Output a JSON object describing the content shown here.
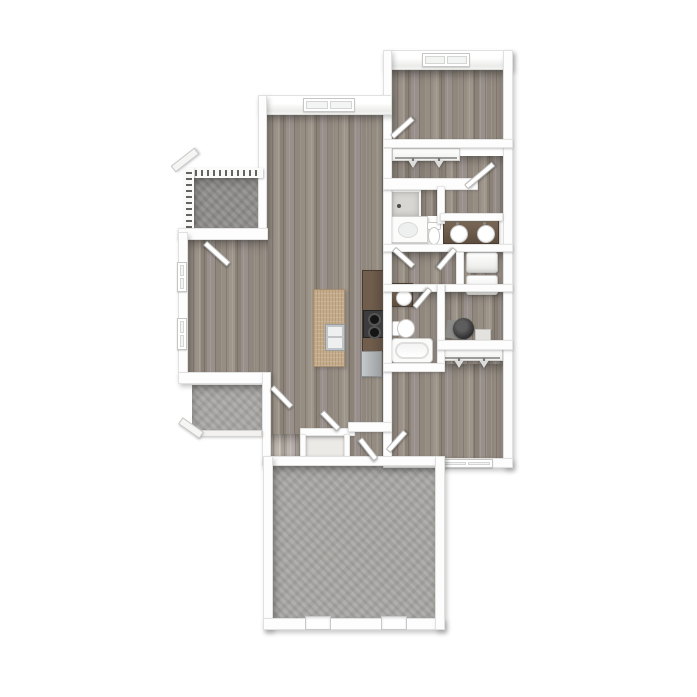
{
  "meta": {
    "description": "3D top-down floor plan rendering of a two-bedroom, two-bath apartment with balcony, entry porch, kitchen island and large patio",
    "visible_text": "none"
  },
  "palette": {
    "background": "#ffffff",
    "wall": "#fdfdfd",
    "wall_edge": "#cfcfcd",
    "wood_floor": "#978e84",
    "concrete_light": "#a9a8a5",
    "concrete_dark": "#8f8e8c",
    "counter_dark": "#5e4d40",
    "island_granite": "#c4ab8b",
    "appliance_steel": "#b7babc",
    "fixture_white": "#fcfcfb",
    "water_heater": "#2d2d2d"
  },
  "elements": [
    {
      "kind": "floor-concrete",
      "variant": "dark",
      "name": "balcony-floor",
      "x": 194,
      "y": 178,
      "w": 69,
      "h": 50
    },
    {
      "kind": "floor-wood",
      "name": "living-dining-floor",
      "x": 267,
      "y": 113,
      "w": 116,
      "h": 345
    },
    {
      "kind": "floor-wood",
      "name": "dining-left-wing-floor",
      "x": 188,
      "y": 240,
      "w": 80,
      "h": 134
    },
    {
      "kind": "floor-wood",
      "name": "bedroom1-floor",
      "x": 392,
      "y": 70,
      "w": 111,
      "h": 70
    },
    {
      "kind": "floor-wood",
      "variant": "dark",
      "name": "master-closet-floor",
      "x": 392,
      "y": 156,
      "w": 68,
      "h": 24
    },
    {
      "kind": "floor-wood",
      "name": "master-bath-right-floor",
      "x": 440,
      "y": 156,
      "w": 63,
      "h": 60
    },
    {
      "kind": "floor-wood",
      "name": "master-bath-left-floor",
      "x": 420,
      "y": 186,
      "w": 18,
      "h": 30
    },
    {
      "kind": "floor-wood",
      "name": "hallway-floor",
      "x": 392,
      "y": 252,
      "w": 66,
      "h": 32
    },
    {
      "kind": "floor-wood",
      "name": "laundry-floor",
      "x": 458,
      "y": 252,
      "w": 45,
      "h": 33
    },
    {
      "kind": "floor-wood",
      "name": "bathroom2-floor",
      "x": 392,
      "y": 292,
      "w": 45,
      "h": 71
    },
    {
      "kind": "floor-wood",
      "name": "utility-floor",
      "x": 445,
      "y": 292,
      "w": 58,
      "h": 50
    },
    {
      "kind": "floor-wood",
      "variant": "dark",
      "name": "bedroom2-closet-floor",
      "x": 440,
      "y": 346,
      "w": 63,
      "h": 20
    },
    {
      "kind": "floor-wood",
      "name": "bedroom2-floor",
      "x": 392,
      "y": 364,
      "w": 111,
      "h": 94
    },
    {
      "kind": "floor-wood",
      "variant": "pale",
      "name": "entry-closet-a-floor",
      "x": 268,
      "y": 434,
      "w": 31,
      "h": 22
    },
    {
      "kind": "floor-tilewhite",
      "name": "entry-closet-b-floor",
      "x": 306,
      "y": 436,
      "w": 40,
      "h": 20
    },
    {
      "kind": "floor-concrete",
      "name": "entry-porch-floor",
      "x": 192,
      "y": 385,
      "w": 70,
      "h": 47
    },
    {
      "kind": "floor-concrete",
      "name": "patio-floor",
      "x": 273,
      "y": 466,
      "w": 162,
      "h": 152
    },
    {
      "kind": "island",
      "name": "kitchen-island",
      "x": 313,
      "y": 289,
      "w": 32,
      "h": 78
    },
    {
      "kind": "counter",
      "name": "kitchen-counter",
      "x": 362,
      "y": 270,
      "w": 25,
      "h": 82
    },
    {
      "kind": "stove",
      "name": "stove-cooktop",
      "x": 363,
      "y": 310,
      "w": 23,
      "h": 28
    },
    {
      "kind": "fridge",
      "name": "refrigerator",
      "x": 361,
      "y": 351,
      "w": 21,
      "h": 26
    },
    {
      "kind": "closetrod",
      "name": "master-closet-rod",
      "x": 392,
      "y": 148,
      "w": 68,
      "h": 13
    },
    {
      "kind": "shower",
      "name": "master-shower",
      "x": 390,
      "y": 190,
      "w": 31,
      "h": 28
    },
    {
      "kind": "vanity-white",
      "name": "master-vanity",
      "x": 391,
      "y": 216,
      "w": 37,
      "h": 27
    },
    {
      "kind": "toilet-down",
      "name": "master-toilet",
      "x": 426,
      "y": 222,
      "w": 14,
      "h": 21
    },
    {
      "kind": "vanity-brown-double",
      "name": "master-double-vanity",
      "x": 443,
      "y": 220,
      "w": 56,
      "h": 24
    },
    {
      "kind": "wd",
      "name": "washer-dryer-stack",
      "x": 466,
      "y": 252,
      "w": 32,
      "h": 43
    },
    {
      "kind": "wh",
      "name": "water-heater",
      "x": 446,
      "y": 316,
      "w": 28,
      "h": 26
    },
    {
      "kind": "shelf",
      "name": "utility-shelf",
      "x": 475,
      "y": 329,
      "w": 16,
      "h": 13
    },
    {
      "kind": "closetrod",
      "name": "bedroom2-closet-rod",
      "x": 440,
      "y": 348,
      "w": 63,
      "h": 13
    },
    {
      "kind": "vanity-brown-single",
      "name": "bathroom2-vanity",
      "x": 391,
      "y": 283,
      "w": 22,
      "h": 24
    },
    {
      "kind": "toilet-right",
      "name": "bathroom2-toilet",
      "x": 392,
      "y": 318,
      "w": 21,
      "h": 19
    },
    {
      "kind": "tub",
      "name": "bathroom2-tub",
      "x": 391,
      "y": 338,
      "w": 42,
      "h": 25
    },
    {
      "kind": "wall",
      "variant": "face outer",
      "name": "bedroom1-top-wall",
      "x": 383,
      "y": 50,
      "w": 130,
      "h": 20
    },
    {
      "kind": "window-h",
      "name": "bedroom1-window",
      "x": 422,
      "y": 53,
      "w": 48,
      "h": 14
    },
    {
      "kind": "wall",
      "variant": "outer",
      "name": "right-exterior-wall",
      "x": 503,
      "y": 50,
      "w": 10,
      "h": 418
    },
    {
      "kind": "wall",
      "variant": "outer",
      "name": "bedroom1-left-wall",
      "x": 383,
      "y": 50,
      "w": 9,
      "h": 90
    },
    {
      "kind": "wall",
      "name": "bedroom1-bottom-wall",
      "x": 383,
      "y": 139,
      "w": 130,
      "h": 9
    },
    {
      "kind": "wall",
      "variant": "face outer",
      "name": "living-top-wall",
      "x": 258,
      "y": 95,
      "w": 134,
      "h": 20
    },
    {
      "kind": "window-h",
      "name": "living-window",
      "x": 303,
      "y": 98,
      "w": 52,
      "h": 14
    },
    {
      "kind": "wall",
      "variant": "outer",
      "name": "living-left-upper-wall",
      "x": 258,
      "y": 95,
      "w": 9,
      "h": 140
    },
    {
      "kind": "railing-h",
      "name": "balcony-railing-top",
      "x": 193,
      "y": 168,
      "w": 70,
      "h": 10
    },
    {
      "kind": "railing-v",
      "name": "balcony-railing-left",
      "x": 184,
      "y": 168,
      "w": 10,
      "h": 62
    },
    {
      "kind": "arm",
      "rot": -38,
      "name": "balcony-roof-arm",
      "x": 170,
      "y": 156,
      "w": 30,
      "h": 8
    },
    {
      "kind": "wall",
      "name": "dining-top-wall",
      "x": 178,
      "y": 228,
      "w": 90,
      "h": 12
    },
    {
      "kind": "wall",
      "variant": "outer",
      "name": "dining-left-wall",
      "x": 178,
      "y": 232,
      "w": 10,
      "h": 146
    },
    {
      "kind": "window-v",
      "name": "dining-window-upper",
      "x": 177,
      "y": 262,
      "w": 10,
      "h": 30
    },
    {
      "kind": "window-v",
      "name": "dining-window-lower",
      "x": 177,
      "y": 318,
      "w": 10,
      "h": 32
    },
    {
      "kind": "wall",
      "variant": "outer",
      "name": "dining-bottom-wall",
      "x": 178,
      "y": 372,
      "w": 92,
      "h": 12
    },
    {
      "kind": "wall",
      "variant": "outer",
      "name": "entry-left-wall",
      "x": 262,
      "y": 372,
      "w": 9,
      "h": 94
    },
    {
      "kind": "curb",
      "name": "porch-curb",
      "x": 196,
      "y": 430,
      "w": 66,
      "h": 7
    },
    {
      "kind": "arm",
      "rot": 35,
      "name": "porch-roof-arm",
      "x": 178,
      "y": 424,
      "w": 26,
      "h": 8
    },
    {
      "kind": "wall",
      "name": "center-east-wall",
      "x": 383,
      "y": 148,
      "w": 9,
      "h": 312
    },
    {
      "kind": "wall",
      "name": "master-closet-bottom-wall",
      "x": 383,
      "y": 178,
      "w": 95,
      "h": 12
    },
    {
      "kind": "wall",
      "name": "master-bath-divider-wall",
      "x": 437,
      "y": 186,
      "w": 8,
      "h": 38
    },
    {
      "kind": "wall",
      "name": "double-vanity-back-wall",
      "x": 440,
      "y": 213,
      "w": 63,
      "h": 8
    },
    {
      "kind": "wall",
      "name": "hallway-top-wall",
      "x": 383,
      "y": 244,
      "w": 130,
      "h": 8
    },
    {
      "kind": "wall",
      "name": "laundry-left-wall",
      "x": 456,
      "y": 252,
      "w": 8,
      "h": 33
    },
    {
      "kind": "wall",
      "name": "hallway-bottom-wall",
      "x": 383,
      "y": 284,
      "w": 62,
      "h": 8
    },
    {
      "kind": "wall",
      "name": "laundry-bottom-wall",
      "x": 445,
      "y": 284,
      "w": 68,
      "h": 8
    },
    {
      "kind": "wall",
      "name": "bath2-utility-divider-wall",
      "x": 437,
      "y": 284,
      "w": 8,
      "h": 80
    },
    {
      "kind": "wall",
      "name": "utility-bottom-wall",
      "x": 437,
      "y": 340,
      "w": 76,
      "h": 10
    },
    {
      "kind": "wall",
      "name": "bathroom2-bottom-wall",
      "x": 383,
      "y": 363,
      "w": 62,
      "h": 9
    },
    {
      "kind": "wall",
      "variant": "outer",
      "name": "bedroom2-bottom-wall",
      "x": 383,
      "y": 458,
      "w": 130,
      "h": 10
    },
    {
      "kind": "window-h",
      "name": "bedroom2-window",
      "x": 441,
      "y": 459,
      "w": 52,
      "h": 9
    },
    {
      "kind": "wall",
      "name": "entry-closets-top-wall",
      "x": 300,
      "y": 428,
      "w": 55,
      "h": 8
    },
    {
      "kind": "wall",
      "name": "bedroom2-door-jog-wall",
      "x": 348,
      "y": 422,
      "w": 44,
      "h": 10
    },
    {
      "kind": "wall",
      "name": "closet-b-left-jamb",
      "x": 300,
      "y": 434,
      "w": 6,
      "h": 24
    },
    {
      "kind": "wall",
      "name": "closet-b-right-jamb",
      "x": 344,
      "y": 434,
      "w": 6,
      "h": 24
    },
    {
      "kind": "wall",
      "variant": "outer",
      "name": "patio-top-wall",
      "x": 263,
      "y": 456,
      "w": 182,
      "h": 10
    },
    {
      "kind": "wall",
      "variant": "outer",
      "name": "patio-left-wall",
      "x": 263,
      "y": 456,
      "w": 10,
      "h": 174
    },
    {
      "kind": "wall",
      "variant": "outer",
      "name": "patio-bottom-wall",
      "x": 263,
      "y": 618,
      "w": 182,
      "h": 12
    },
    {
      "kind": "wall",
      "variant": "outer",
      "name": "patio-right-wall",
      "x": 435,
      "y": 456,
      "w": 10,
      "h": 174
    },
    {
      "kind": "opening",
      "name": "patio-opening-left",
      "x": 305,
      "y": 616,
      "w": 26,
      "h": 14
    },
    {
      "kind": "opening",
      "name": "patio-opening-right",
      "x": 381,
      "y": 616,
      "w": 26,
      "h": 14
    },
    {
      "kind": "door",
      "rot": -42,
      "name": "bedroom1-door",
      "x": 392,
      "y": 134,
      "w": 28,
      "h": 6
    },
    {
      "kind": "door",
      "rot": 42,
      "name": "balcony-door",
      "x": 205,
      "y": 240,
      "w": 32,
      "h": 6
    },
    {
      "kind": "door",
      "rot": 46,
      "name": "front-entry-door",
      "x": 272,
      "y": 384,
      "w": 28,
      "h": 6
    },
    {
      "kind": "door",
      "rot": 46,
      "name": "entry-closet-door",
      "x": 322,
      "y": 409,
      "w": 24,
      "h": 6
    },
    {
      "kind": "door",
      "rot": 52,
      "name": "bedroom2-hall-door",
      "x": 360,
      "y": 436,
      "w": 26,
      "h": 6
    },
    {
      "kind": "door",
      "rot": -48,
      "name": "bedroom2-door",
      "x": 388,
      "y": 448,
      "w": 26,
      "h": 6
    },
    {
      "kind": "door",
      "rot": -40,
      "name": "master-bath-door",
      "x": 466,
      "y": 184,
      "w": 36,
      "h": 6
    },
    {
      "kind": "door",
      "rot": 42,
      "name": "hallway-door",
      "x": 394,
      "y": 246,
      "w": 26,
      "h": 6
    },
    {
      "kind": "door",
      "rot": 130,
      "name": "laundry-door",
      "x": 455,
      "y": 246,
      "w": 26,
      "h": 6
    },
    {
      "kind": "door",
      "rot": 130,
      "name": "bathroom2-door",
      "x": 430,
      "y": 286,
      "w": 24,
      "h": 6
    }
  ]
}
